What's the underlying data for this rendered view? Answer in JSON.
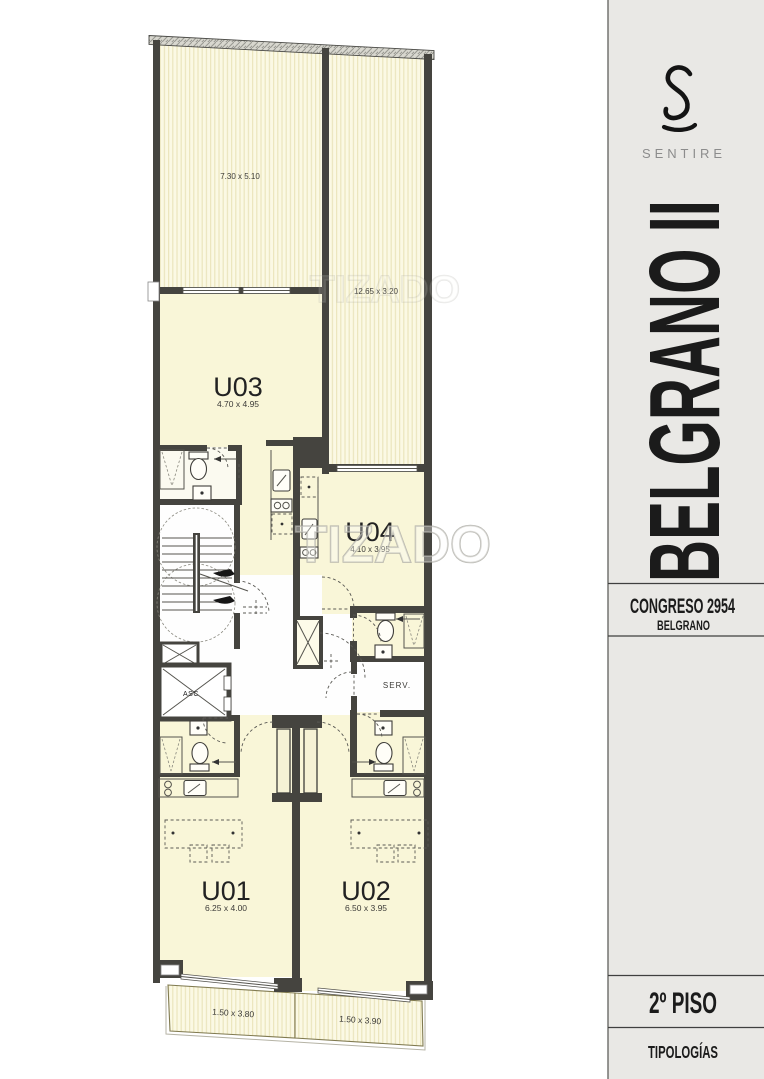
{
  "sidebar": {
    "logo_letter": "S",
    "brand": "SENTIRE",
    "project": "BELGRANO II",
    "address": "CONGRESO 2954",
    "neighborhood": "BELGRANO",
    "floor": "2º PISO",
    "caption": "TIPOLOGÍAS"
  },
  "plan": {
    "watermark": "TIZADO",
    "units": [
      {
        "id": "U01",
        "dims": "6.25 x 4.00"
      },
      {
        "id": "U02",
        "dims": "6.50 x 3.95"
      },
      {
        "id": "U03",
        "dims": "4.70 x 4.95"
      },
      {
        "id": "U04",
        "dims": "4.10 x 3.95"
      }
    ],
    "terraces": [
      {
        "dims": "7.30 x 5.10"
      },
      {
        "dims": "12.65 x 3.20"
      }
    ],
    "balconies": [
      {
        "dims": "1.50 x 3.80"
      },
      {
        "dims": "1.50 x 3.90"
      }
    ],
    "elevator": "ASC",
    "service": "SERV."
  },
  "colors": {
    "wall": "#45443f",
    "room_fill": "#f9f6d8",
    "terrace_fill": "#fbf9e4",
    "terrace_stripe": "#ebe5bd",
    "sidebar_bg": "#e9e8e5",
    "divider": "#3f3f3f",
    "muted_text": "#8c8c8c"
  }
}
